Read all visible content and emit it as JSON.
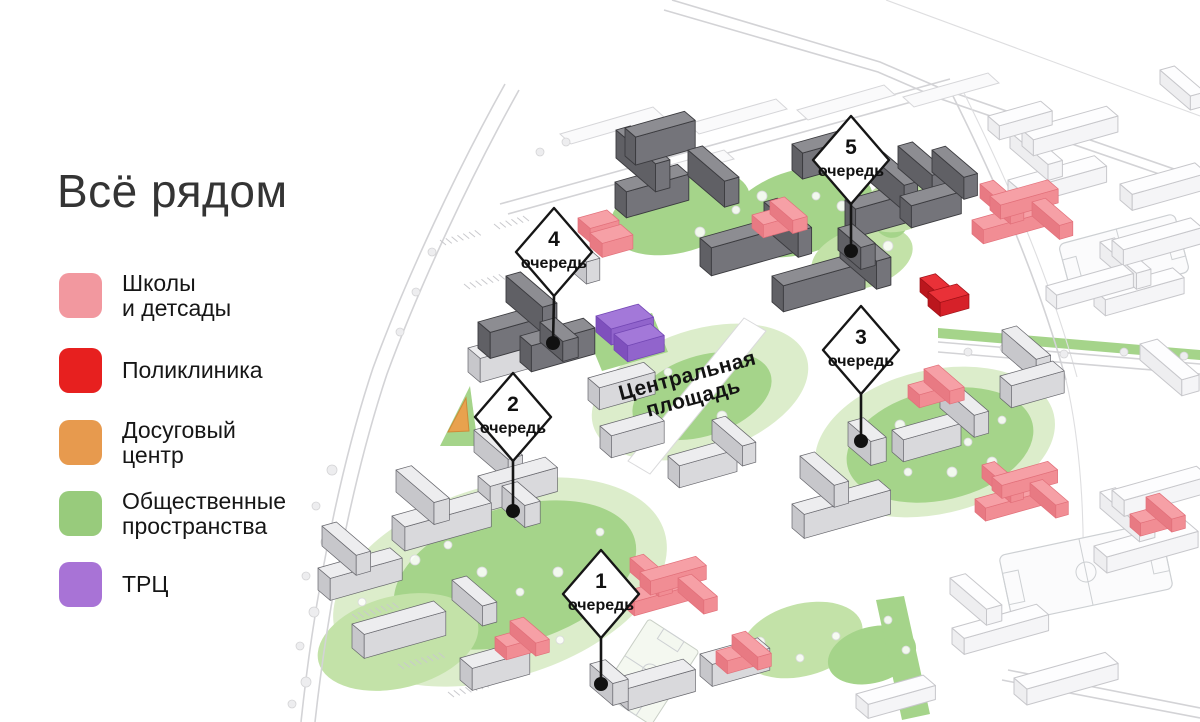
{
  "title": "Всё рядом",
  "legend": {
    "items": [
      {
        "line1": "Школы",
        "line2": "и детсады",
        "color": "#F2989F"
      },
      {
        "line1": "Поликлиника",
        "line2": "",
        "color": "#E7201F"
      },
      {
        "line1": "Досуговый",
        "line2": "центр",
        "color": "#E79A4E"
      },
      {
        "line1": "Общественные",
        "line2": "пространства",
        "color": "#98CB7C"
      },
      {
        "line1": "ТРЦ",
        "line2": "",
        "color": "#A873D6"
      }
    ]
  },
  "map": {
    "central_square_label": {
      "line1": "Центральная",
      "line2": "площадь"
    },
    "phases": [
      {
        "number": "1",
        "word": "очередь"
      },
      {
        "number": "2",
        "word": "очередь"
      },
      {
        "number": "3",
        "word": "очередь"
      },
      {
        "number": "4",
        "word": "очередь"
      },
      {
        "number": "5",
        "word": "очередь"
      }
    ],
    "colors": {
      "schools_kindergartens": "#F2989F",
      "polyclinic": "#E7201F",
      "leisure_center": "#E79A4E",
      "public_spaces": "#A5D48A",
      "mall": "#A378D9",
      "project_buildings_dark": "#8D8D92",
      "project_buildings_light": "#EDEDEF",
      "context_buildings": "#FDFDFE"
    }
  }
}
